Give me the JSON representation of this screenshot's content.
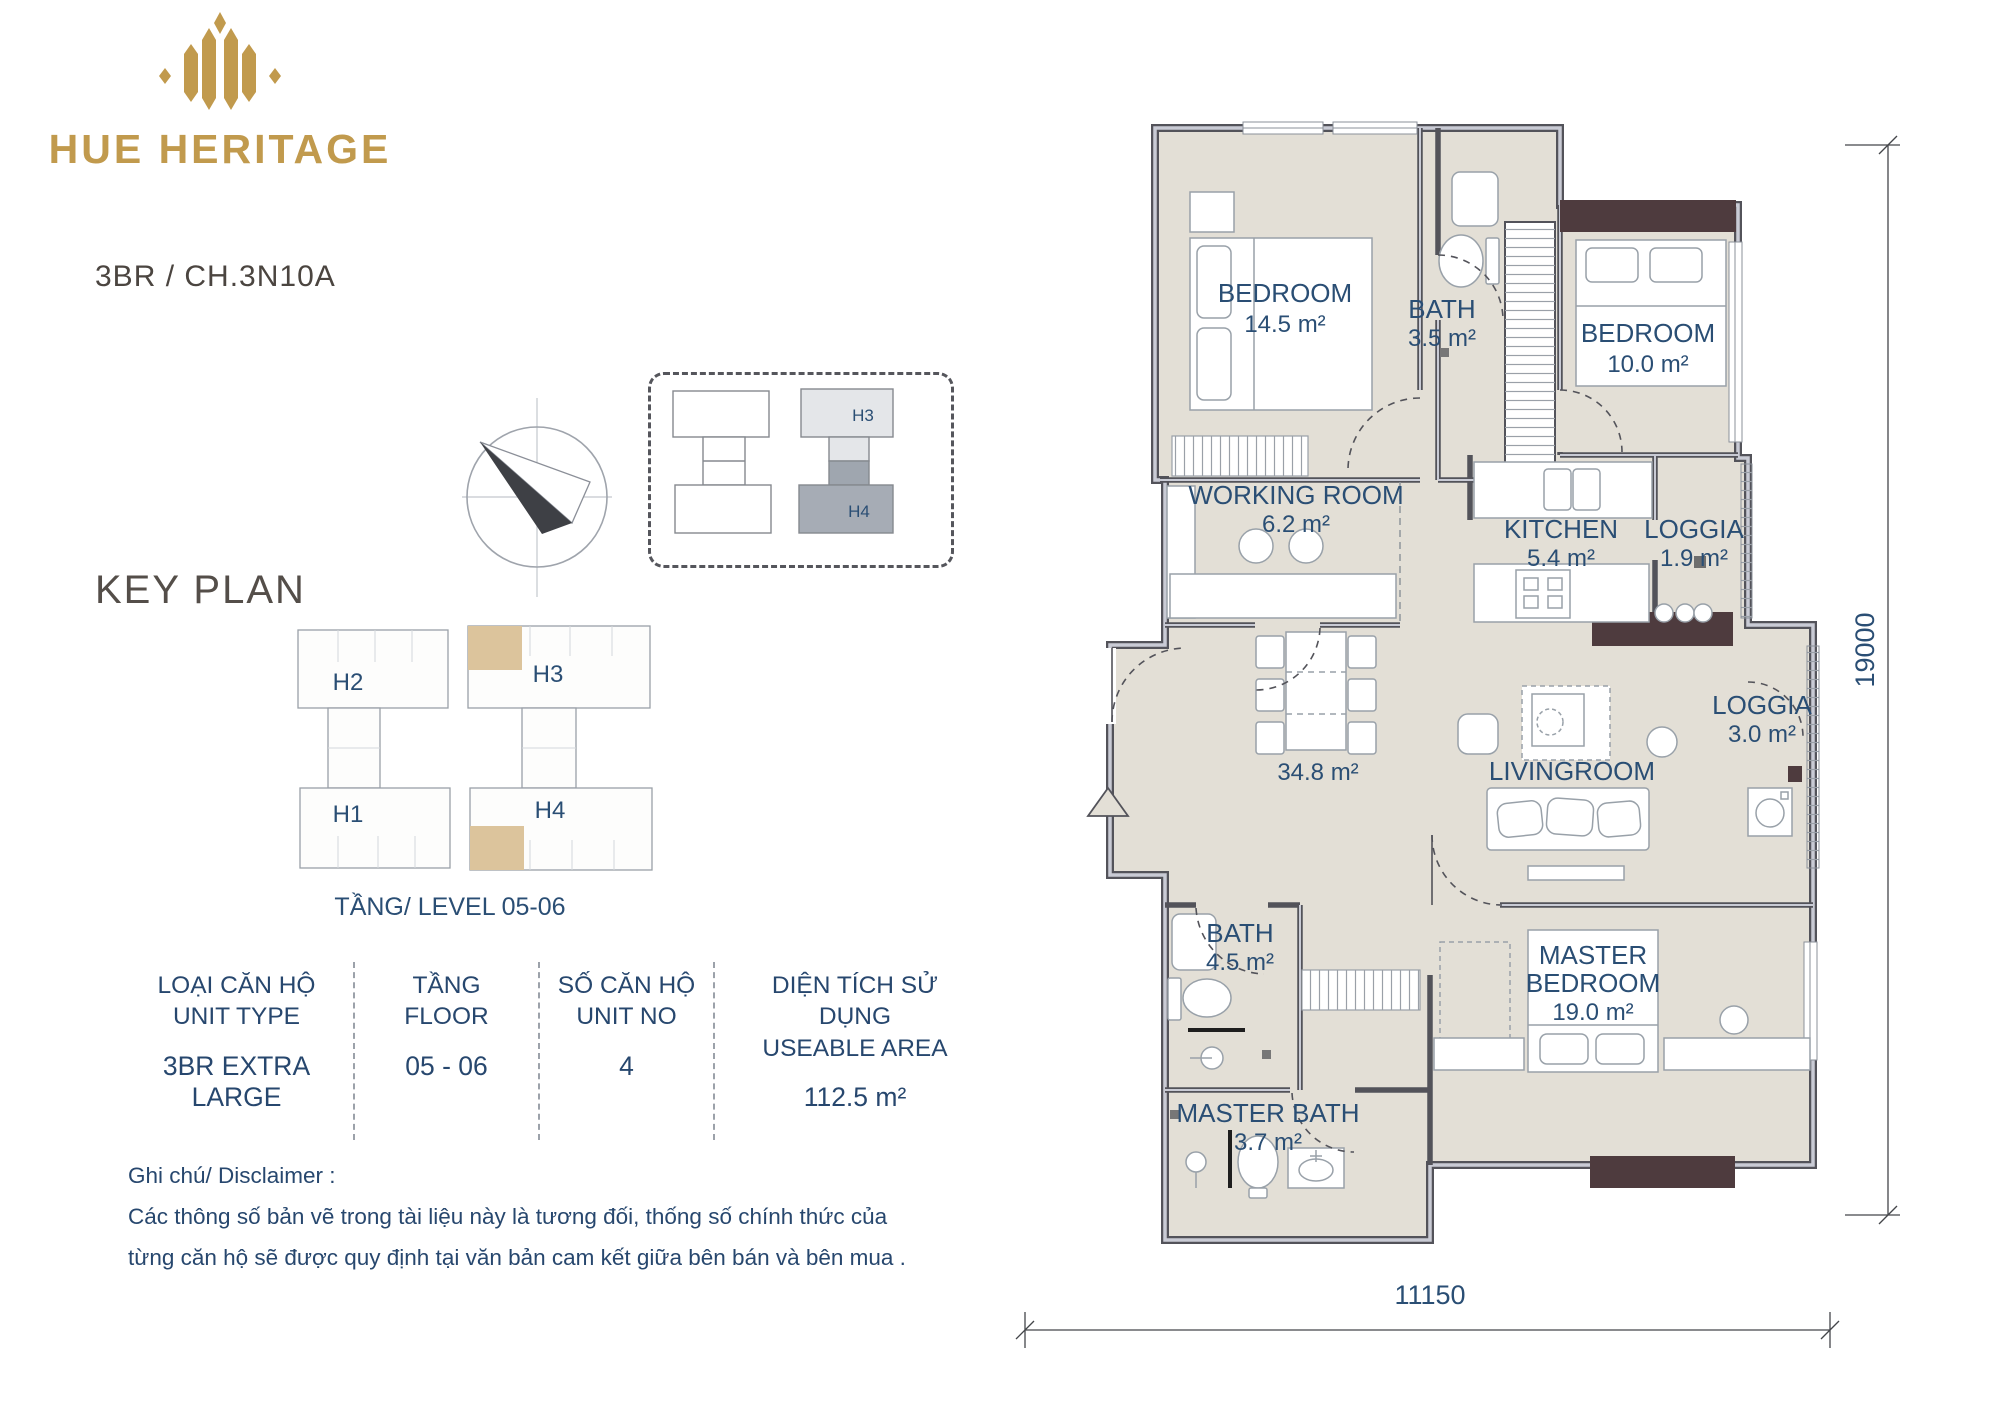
{
  "brand": {
    "name": "HUE HERITAGE",
    "unit_code": "3BR / CH.3N10A",
    "gold": "#C19A4D"
  },
  "site_plan": {
    "block_top": "H3",
    "block_bottom": "H4"
  },
  "key_plan": {
    "title": "KEY PLAN",
    "buildings": {
      "left_top": "H2",
      "left_bottom": "H1",
      "right_top": "H3",
      "right_bottom": "H4"
    },
    "level_caption": "TẦNG/ LEVEL 05-06",
    "highlight_color": "#DCC49C"
  },
  "info_table": {
    "columns": [
      {
        "label_vi": "LOẠI CĂN HỘ",
        "label_en": "UNIT TYPE",
        "value": "3BR EXTRA LARGE"
      },
      {
        "label_vi": "TẦNG",
        "label_en": "FLOOR",
        "value": "05 - 06"
      },
      {
        "label_vi": "SỐ CĂN HỘ",
        "label_en": "UNIT NO",
        "value": "4"
      },
      {
        "label_vi": "DIỆN TÍCH SỬ DỤNG",
        "label_en": "USEABLE AREA",
        "value": "112.5 m²"
      }
    ]
  },
  "disclaimer": {
    "title": "Ghi chú/ Disclaimer :",
    "line1": "Các thông số bản vẽ trong tài liệu này là tương đối, thống số chính thức của",
    "line2": "từng căn hộ sẽ được quy định tại văn bản cam kết giữa bên bán và bên mua ."
  },
  "floor_plan": {
    "rooms": {
      "bedroom1": {
        "name": "BEDROOM",
        "area": "14.5 m²"
      },
      "bath1": {
        "name": "BATH",
        "area": "3.5 m²"
      },
      "bedroom2": {
        "name": "BEDROOM",
        "area": "10.0 m²"
      },
      "working": {
        "name": "WORKING ROOM",
        "area": "6.2 m²"
      },
      "kitchen": {
        "name": "KITCHEN",
        "area": "5.4 m²"
      },
      "loggia1": {
        "name": "LOGGIA",
        "area": "1.9 m²"
      },
      "dining": {
        "area": "34.8 m²"
      },
      "living": {
        "name": "LIVINGROOM"
      },
      "loggia2": {
        "name": "LOGGIA",
        "area": "3.0 m²"
      },
      "bath2": {
        "name": "BATH",
        "area": "4.5 m²"
      },
      "master": {
        "name_line1": "MASTER",
        "name_line2": "BEDROOM",
        "area": "19.0 m²"
      },
      "masterbath": {
        "name": "MASTER BATH",
        "area": "3.7 m²"
      }
    },
    "dimensions": {
      "height": "19000",
      "width": "11150"
    },
    "colors": {
      "floor": "#E3DFD6",
      "wall": "#53535A",
      "accent_wall": "#4E3B3E",
      "label": "#2A4E74"
    }
  }
}
